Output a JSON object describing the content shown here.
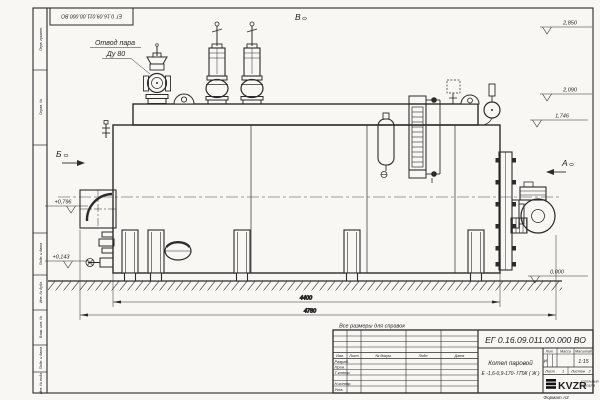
{
  "frame": {
    "stamp_designation": "ЕГ 0.16.09.011.00.000  ВО",
    "left_labels": {
      "l1": "Перв. примен.",
      "l2": "Справ. №",
      "l3": "Подп. и дата",
      "l4": "Инв. № дубл.",
      "l5": "Взам. инв. №",
      "l6": "Подп. и дата",
      "l7": "Инв. № подл."
    },
    "format_note": "Формат А3"
  },
  "views": {
    "top": "В",
    "left": "Б",
    "right": "А"
  },
  "callouts": {
    "steam_line1": "Отвод пара",
    "steam_line2": "Ду 80"
  },
  "elevations": {
    "e2850": "2,850",
    "e2090": "2,090",
    "e1746": "1,746",
    "e0796": "+0,796",
    "e0143": "+0,143",
    "e0000": "0,000"
  },
  "dimensions": {
    "inner": "4400",
    "overall": "4780",
    "note": "Все размеры для справок"
  },
  "title_block": {
    "designation": "ЕГ 0.16.09.011.00.000  ВО",
    "name_line1": "Котел паровой",
    "name_line2": "Е -1,6-0,9-170- ГПЖ ( Ж )",
    "header": {
      "izm": "Изм.",
      "list": "Лист",
      "doc": "№ докум.",
      "podp": "Подп.",
      "data": "Дата"
    },
    "rows": {
      "r1": "Разраб.",
      "r2": "Пров.",
      "r3": "Т.контр.",
      "r4": "Н.контр.",
      "r5": "Утв."
    },
    "lit_label": "Лит.",
    "lit_value": "И",
    "mass_label": "Масса",
    "scale_label": "Масштаб",
    "scale_value": "1:15",
    "sheet_label": "Лист",
    "sheet_value": "1",
    "sheets_label": "Листов",
    "sheets_value": "2",
    "logo_text": "KVZR",
    "logo_caption1": "КОТЕЛЬНЫЙ",
    "logo_caption2": "ЗАВОД РФ"
  }
}
